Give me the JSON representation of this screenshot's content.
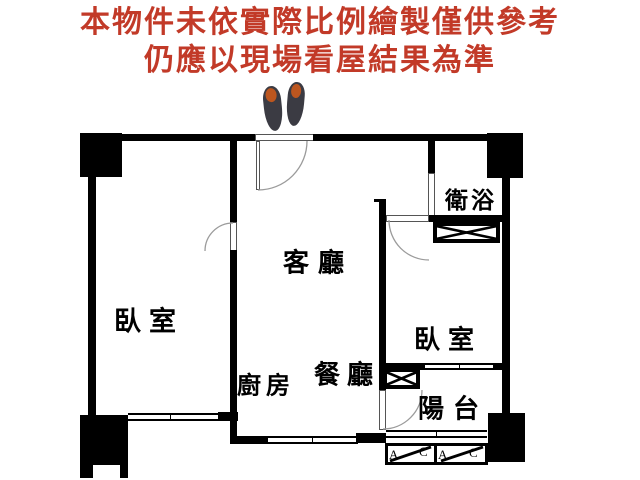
{
  "disclaimer": {
    "line1": "本物件未依實際比例繪製僅供參考",
    "line2": "仍應以現場看屋結果為準",
    "color": "#c23a28"
  },
  "floorplan": {
    "rooms": {
      "living": {
        "label": "客廳"
      },
      "bedroom_left": {
        "label": "臥室"
      },
      "bedroom_right": {
        "label": "臥室"
      },
      "bathroom": {
        "label": "衛浴"
      },
      "kitchen": {
        "label": "廚房"
      },
      "dining": {
        "label": "餐廳"
      },
      "balcony": {
        "label": "陽台"
      }
    },
    "ac_units": [
      {
        "a": "A",
        "c": "C"
      },
      {
        "a": "A",
        "c": "C"
      }
    ],
    "icons": {
      "entrance": "shoes-icon",
      "bathroom_storage": "crossed-box-icon",
      "balcony_storage": "crossed-box-icon",
      "ac_symbol": "diagonal-rect-icon"
    },
    "colors": {
      "wall": "#000000",
      "door_arc": "#9b9b9b",
      "shoe_body": "#3b3b43",
      "shoe_insole": "#bc561f",
      "label_text": "#000000"
    }
  }
}
